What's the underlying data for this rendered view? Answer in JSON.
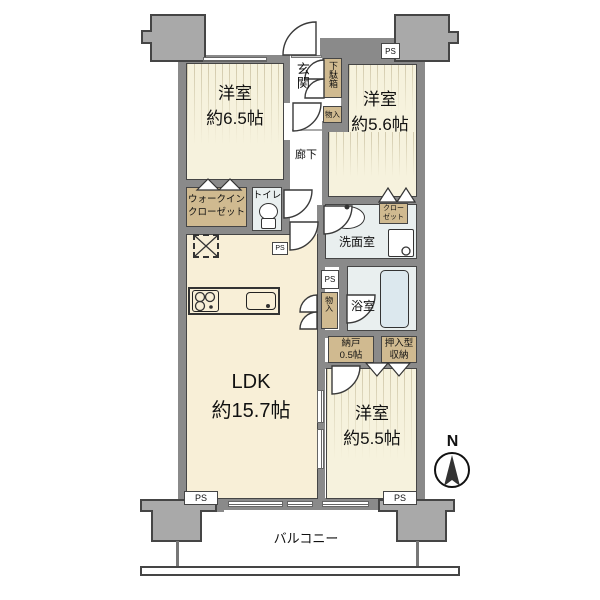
{
  "rooms": {
    "bedroom_a": {
      "type": "洋室",
      "size": "約6.5帖"
    },
    "bedroom_b": {
      "type": "洋室",
      "size": "約5.6帖"
    },
    "bedroom_c": {
      "type": "洋室",
      "size": "約5.5帖"
    },
    "ldk": {
      "type": "LDK",
      "size": "約15.7帖"
    },
    "entrance": "玄関",
    "corridor": "廊下",
    "toilet": "トイレ",
    "wic": {
      "line1": "ウォークイン",
      "line2": "クローゼット"
    },
    "washroom": "洗面室",
    "bathroom": "浴室",
    "shoe_cabinet": "下駄箱",
    "storage_entrance": "物入",
    "storage_bath": "物入",
    "closet": {
      "line1": "クロー",
      "line2": "ゼット"
    },
    "nando": {
      "line1": "納戸",
      "line2": "0.5帖"
    },
    "oshiire": {
      "line1": "押入型",
      "line2": "収納"
    },
    "balcony": "バルコニー"
  },
  "labels": {
    "ps": "PS",
    "north": "N"
  },
  "colors": {
    "wall": "#8a8a8a",
    "column": "#a9a9a9",
    "room_fill": "#f6f2dd",
    "ldk_fill": "#f8efd7",
    "storage_fill": "#d0ba90",
    "wet_fill": "#e9efef",
    "outline": "#454545"
  }
}
